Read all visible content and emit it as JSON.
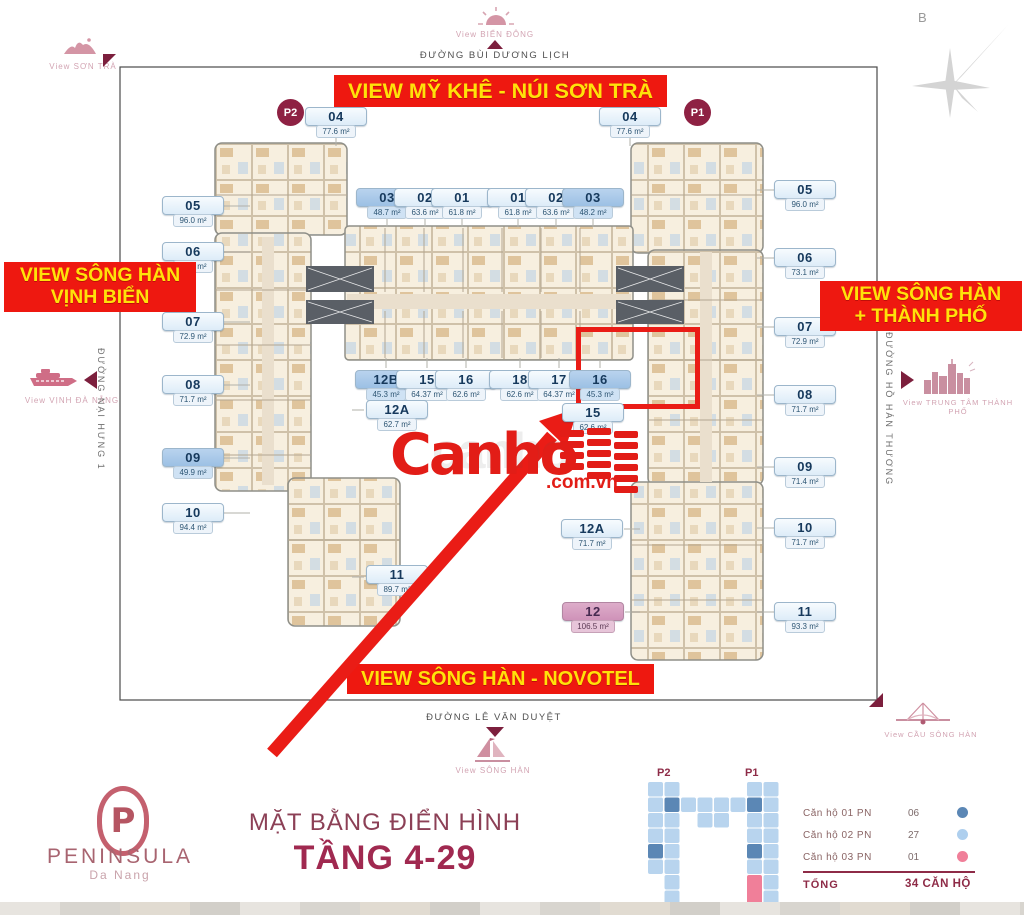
{
  "compass": {
    "label": "B"
  },
  "towers": {
    "p2": "P2",
    "p1": "P1"
  },
  "banners": {
    "top": "VIEW MỸ KHÊ - NÚI SƠN TRÀ",
    "left_line1": "VIEW SÔNG HÀN",
    "left_line2": "VỊNH BIỂN",
    "right_line1": "VIEW SÔNG HÀN",
    "right_line2": "+ THÀNH PHỐ",
    "bottom": "VIEW SÔNG HÀN - NOVOTEL"
  },
  "views": {
    "son_tra": "View SƠN TRÀ",
    "bien_dong": "View BIỂN ĐÔNG",
    "vinh_da_nang": "View VỊNH ĐÀ NẴNG",
    "trung_tam": "View TRUNG TÂM THÀNH PHỐ",
    "song_han": "View SÔNG HÀN",
    "cau_song_han": "View CẦU SÔNG HÀN"
  },
  "streets": {
    "top": "ĐƯỜNG BÙI DƯƠNG LỊCH",
    "left": "ĐƯỜNG NẠI HƯNG 1",
    "right": "ĐƯỜNG HỒ HÁN THƯƠNG",
    "bottom": "ĐƯỜNG LÊ VĂN DUYỆT"
  },
  "watermark": {
    "brand": "Canho",
    "suffix": ".com.vn",
    "ghost": "canho"
  },
  "units": [
    {
      "number": "04",
      "area": "77.6 m²",
      "cls": "unit"
    },
    {
      "number": "03",
      "area": "48.7 m²",
      "cls": "unit dark"
    },
    {
      "number": "02",
      "area": "63.6 m²",
      "cls": "unit"
    },
    {
      "number": "01",
      "area": "61.8 m²",
      "cls": "unit"
    },
    {
      "number": "01",
      "area": "61.8 m²",
      "cls": "unit"
    },
    {
      "number": "02",
      "area": "63.6 m²",
      "cls": "unit"
    },
    {
      "number": "03",
      "area": "48.2 m²",
      "cls": "unit dark"
    },
    {
      "number": "04",
      "area": "77.6 m²",
      "cls": "unit"
    },
    {
      "number": "05",
      "area": "96.0 m²",
      "cls": "unit"
    },
    {
      "number": "06",
      "area": "73.1 m²",
      "cls": "unit"
    },
    {
      "number": "07",
      "area": "72.9 m²",
      "cls": "unit"
    },
    {
      "number": "08",
      "area": "71.7 m²",
      "cls": "unit"
    },
    {
      "number": "09",
      "area": "49.9 m²",
      "cls": "unit dark"
    },
    {
      "number": "10",
      "area": "94.4 m²",
      "cls": "unit"
    },
    {
      "number": "11",
      "area": "89.7 m²",
      "cls": "unit"
    },
    {
      "number": "05",
      "area": "96.0 m²",
      "cls": "unit"
    },
    {
      "number": "06",
      "area": "73.1 m²",
      "cls": "unit"
    },
    {
      "number": "07",
      "area": "72.9 m²",
      "cls": "unit"
    },
    {
      "number": "08",
      "area": "71.7 m²",
      "cls": "unit"
    },
    {
      "number": "09",
      "area": "71.4 m²",
      "cls": "unit"
    },
    {
      "number": "10",
      "area": "71.7 m²",
      "cls": "unit"
    },
    {
      "number": "11",
      "area": "93.3 m²",
      "cls": "unit"
    },
    {
      "number": "12B",
      "area": "45.3 m²",
      "cls": "unit dark"
    },
    {
      "number": "15",
      "area": "64.37 m²",
      "cls": "unit"
    },
    {
      "number": "16",
      "area": "62.6 m²",
      "cls": "unit"
    },
    {
      "number": "18",
      "area": "62.6 m²",
      "cls": "unit"
    },
    {
      "number": "17",
      "area": "64.37 m²",
      "cls": "unit"
    },
    {
      "number": "16",
      "area": "45.3 m²",
      "cls": "unit dark"
    },
    {
      "number": "12A",
      "area": "62.7 m²",
      "cls": "unit"
    },
    {
      "number": "15",
      "area": "62.6 m²",
      "cls": "unit"
    },
    {
      "number": "12A",
      "area": "71.7 m²",
      "cls": "unit"
    },
    {
      "number": "12",
      "area": "106.5 m²",
      "cls": "unit pink"
    }
  ],
  "footer": {
    "logo_p": "P",
    "logo_title": "PENINSULA",
    "logo_subtitle": "Da Nang",
    "plan_title": "MẶT BẰNG ĐIỂN HÌNH",
    "plan_floors": "TẦNG 4-29"
  },
  "legend": {
    "rows": [
      {
        "label": "Căn hộ 01 PN",
        "value": "06",
        "color": "#5b87b5"
      },
      {
        "label": "Căn hộ 02 PN",
        "value": "27",
        "color": "#aecfee"
      },
      {
        "label": "Căn hộ 03 PN",
        "value": "01",
        "color": "#f07f99"
      }
    ],
    "total_label": "TỔNG",
    "total_value": "34 CĂN HỘ"
  },
  "colors": {
    "banner_red": "#ee1810",
    "banner_yellow": "#ffe20a",
    "dark_red": "#8e2143",
    "accent_red": "#ea1c16",
    "label_blue": "#9cc0e4",
    "label_pink": "#cf92b9",
    "legend_dark_blue": "#5b87b5",
    "legend_light_blue": "#aecfee",
    "legend_pink": "#f07f99"
  }
}
